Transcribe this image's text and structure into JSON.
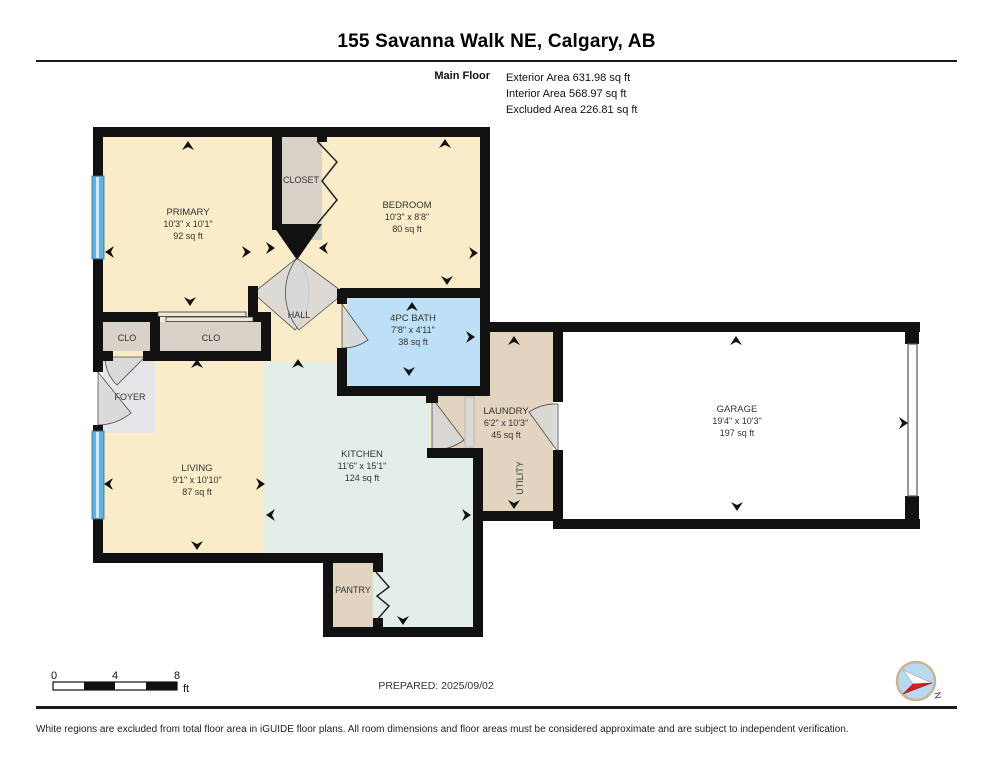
{
  "header": {
    "title": "155 Savanna Walk NE, Calgary, AB",
    "floor_label": "Main Floor",
    "stats": [
      "Exterior Area 631.98 sq ft",
      "Interior Area 568.97 sq ft",
      "Excluded Area 226.81 sq ft"
    ]
  },
  "rooms": {
    "primary": {
      "name": "PRIMARY",
      "dims": "10'3\" x 10'1\"",
      "area": "92 sq ft"
    },
    "closet": {
      "name": "CLOSET"
    },
    "bedroom": {
      "name": "BEDROOM",
      "dims": "10'3\" x 8'8\"",
      "area": "80 sq ft"
    },
    "hall": {
      "name": "HALL"
    },
    "clo1": {
      "name": "CLO"
    },
    "clo2": {
      "name": "CLO"
    },
    "bath": {
      "name": "4PC BATH",
      "dims": "7'8\" x 4'11\"",
      "area": "38 sq ft"
    },
    "foyer": {
      "name": "FOYER"
    },
    "living": {
      "name": "LIVING",
      "dims": "9'1\" x 10'10\"",
      "area": "87 sq ft"
    },
    "kitchen": {
      "name": "KITCHEN",
      "dims": "11'6\" x 15'1\"",
      "area": "124 sq ft"
    },
    "pantry": {
      "name": "PANTRY"
    },
    "laundry": {
      "name": "LAUNDRY",
      "dims": "6'2\" x 10'3\"",
      "area": "45 sq ft"
    },
    "utility": {
      "name": "UTILITY"
    },
    "garage": {
      "name": "GARAGE",
      "dims": "19'4\" x 10'3\"",
      "area": "197 sq ft"
    }
  },
  "scale_bar": {
    "labels": [
      "0",
      "4",
      "8"
    ],
    "unit": "ft"
  },
  "footer": {
    "prepared": "PREPARED: 2025/09/02",
    "compass_label": "N",
    "disclaimer": "White regions are excluded from total floor area in iGUIDE floor plans. All room dimensions and floor areas must be considered approximate and are subject to independent verification."
  },
  "colors": {
    "wall": "#111111",
    "room_cream": "#FAECC8",
    "room_mint": "#E3EEE8",
    "room_blue": "#BEE0F6",
    "room_tan": "#E3D4BF",
    "room_gray": "#D8D1C7",
    "foyer_gray": "#E6E6E8",
    "window_blue": "#5FB2E2",
    "window_blue_light": "#CFE9F8",
    "door_swing": "#D8D8D8",
    "compass_red": "#CC2222",
    "compass_ring": "#C9B493",
    "compass_fill": "#B8D9F0"
  }
}
